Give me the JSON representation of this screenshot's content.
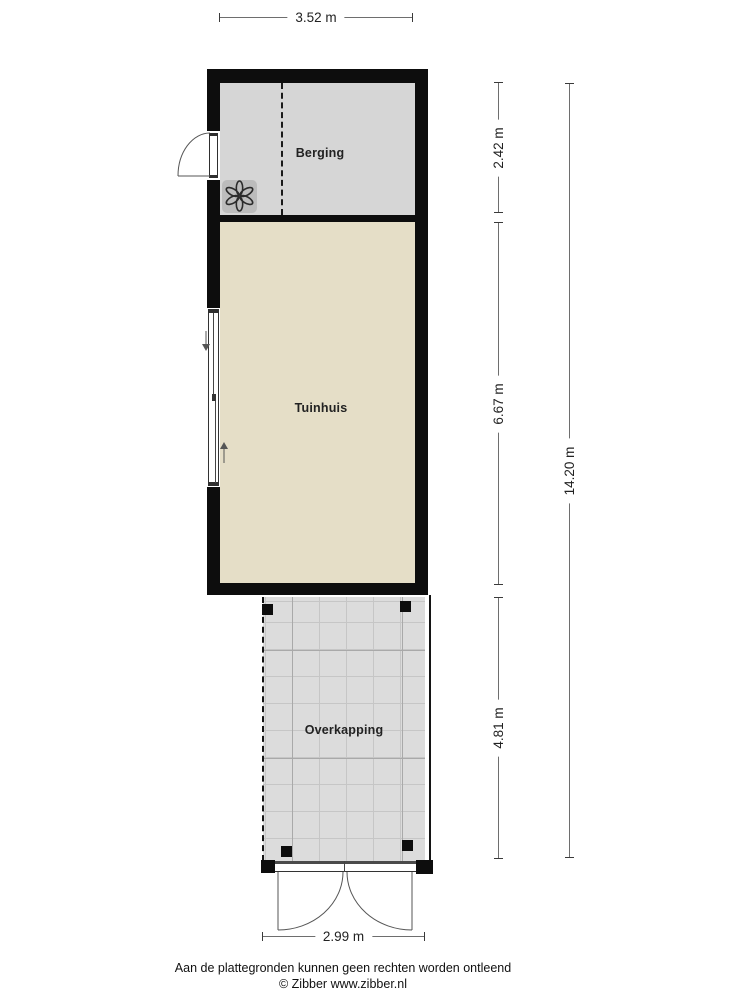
{
  "rooms": {
    "berging": {
      "label": "Berging"
    },
    "tuinhuis": {
      "label": "Tuinhuis"
    },
    "overkapping": {
      "label": "Overkapping"
    }
  },
  "dimensions": {
    "width_top": {
      "label": "3.52 m"
    },
    "berging_depth": {
      "label": "2.42 m"
    },
    "tuinhuis_depth": {
      "label": "6.67 m"
    },
    "overkapping_depth": {
      "label": "4.81 m"
    },
    "total_depth": {
      "label": "14.20 m"
    },
    "width_bottom": {
      "label": "2.99 m"
    }
  },
  "footer": {
    "disclaimer": "Aan de plattegronden kunnen geen rechten worden ontleend",
    "credit": "© Zibber www.zibber.nl"
  },
  "icons": {
    "ventilation": "ventilation-fan-icon"
  },
  "colors": {
    "wall": "#0d0d0d",
    "berging_floor": "#d6d6d6",
    "tuinhuis_floor": "#e5dec7",
    "overkapping_floor": "#dcdcdc",
    "grid_line": "#c6c6c6",
    "vent_box": "#bcbcbc",
    "dimension_line": "#6e6e6e",
    "text": "#1c1c1c"
  }
}
